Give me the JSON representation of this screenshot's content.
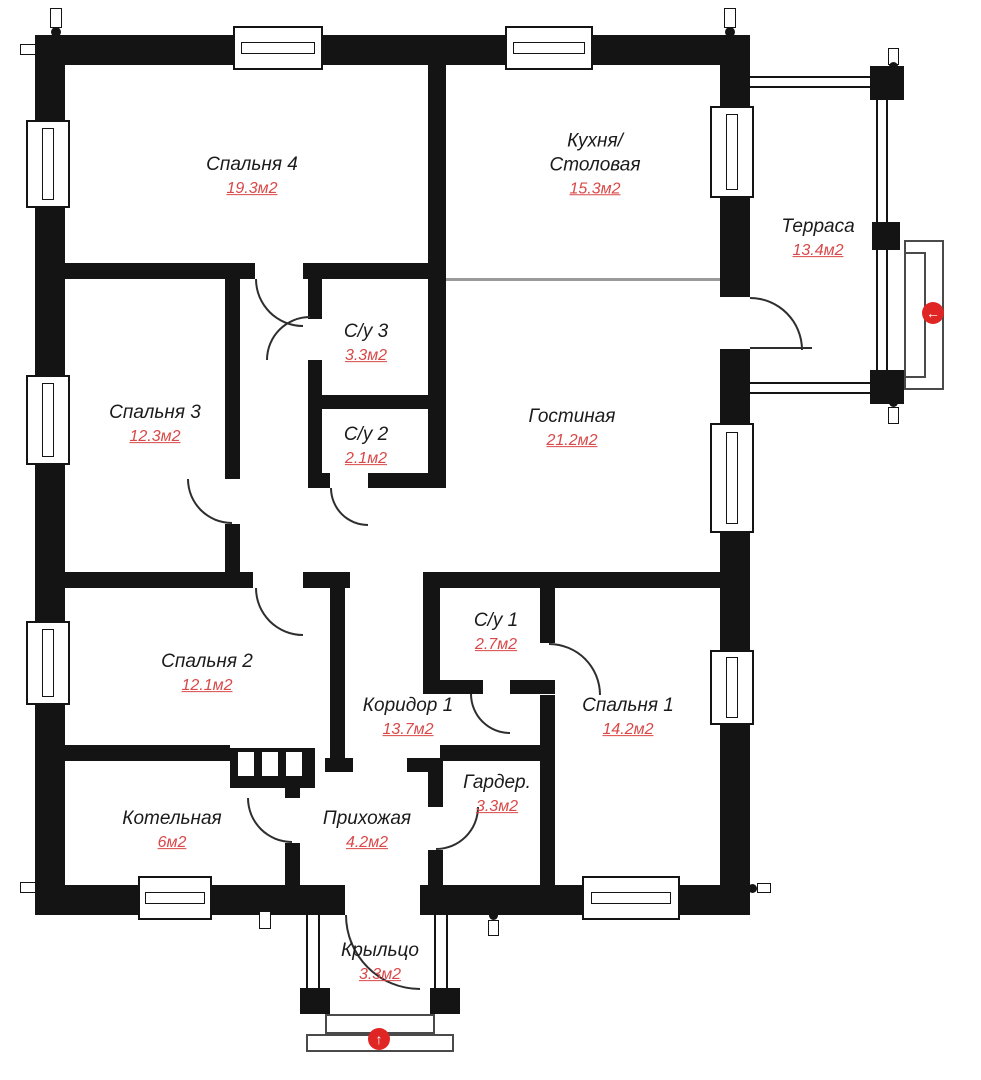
{
  "floor_plan": {
    "rooms": [
      {
        "id": "bedroom-4",
        "name": "Спальня 4",
        "area": "19.3м2"
      },
      {
        "id": "kitchen-dining",
        "name": "Кухня/ Столовая",
        "area": "15.3м2"
      },
      {
        "id": "terrace",
        "name": "Терраса",
        "area": "13.4м2"
      },
      {
        "id": "bathroom-3",
        "name": "С/у 3",
        "area": "3.3м2"
      },
      {
        "id": "bedroom-3",
        "name": "Спальня 3",
        "area": "12.3м2"
      },
      {
        "id": "bathroom-2",
        "name": "С/у 2",
        "area": "2.1м2"
      },
      {
        "id": "living-room",
        "name": "Гостиная",
        "area": "21.2м2"
      },
      {
        "id": "bedroom-2",
        "name": "Спальня 2",
        "area": "12.1м2"
      },
      {
        "id": "bathroom-1",
        "name": "С/у 1",
        "area": "2.7м2"
      },
      {
        "id": "corridor-1",
        "name": "Коридор 1",
        "area": "13.7м2"
      },
      {
        "id": "bedroom-1",
        "name": "Спальня 1",
        "area": "14.2м2"
      },
      {
        "id": "boiler-room",
        "name": "Котельная",
        "area": "6м2"
      },
      {
        "id": "hallway",
        "name": "Прихожая",
        "area": "4.2м2"
      },
      {
        "id": "wardrobe",
        "name": "Гардер.",
        "area": "3.3м2"
      },
      {
        "id": "porch",
        "name": "Крыльцо",
        "area": "3.3м2"
      }
    ],
    "entrance_markers": [
      {
        "symbol": "←",
        "location": "terrace"
      },
      {
        "symbol": "↑",
        "location": "porch"
      }
    ],
    "colors": {
      "wall": "#141414",
      "area_text": "#d94848",
      "name_text": "#1b1b1b",
      "marker_red": "#e02525"
    }
  }
}
